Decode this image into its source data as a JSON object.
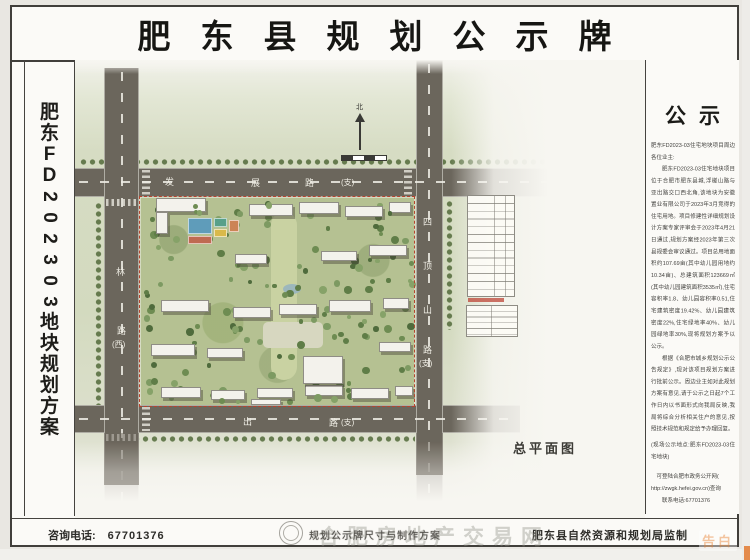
{
  "title": "肥东县规划公示牌",
  "left_panel": {
    "chars": [
      "肥",
      "东",
      "F",
      "D",
      "2",
      "0",
      "2",
      "3",
      "0",
      "3",
      "地",
      "块",
      "规",
      "划",
      "方",
      "案"
    ]
  },
  "map": {
    "caption": "总平面图",
    "north_label": "北",
    "road_top": [
      "发",
      "展",
      "路",
      "(支)"
    ],
    "road_left": [
      "林",
      "路",
      "(西)"
    ],
    "road_right": [
      "四",
      "顶",
      "山",
      "路",
      "(支)"
    ],
    "road_bottom": [
      "出",
      "路",
      "(支)"
    ]
  },
  "notice": {
    "heading": "公示",
    "salutation": "肥东FD2023-03住宅地块项目周边各位业主:",
    "paragraphs": [
      "肥东FD2023-03住宅地块项目位于合肥市肥东县城,浮槎山路与亚出路交口西北角,该地块为安徽置业有限公司于2023年3月竞得的住宅用地。项目修建性详细规划设计方案专家评审会于2023年4月21日通过,规划方案经2023年第三次县规委会审议通过。项目总用地面积约107.69亩(其中幼儿园用地约10.34亩)、总建筑面积123669㎡(其中幼儿园建筑面积3535㎡),住宅容积率1.8、幼儿园容积率0.51,住宅建筑密度19.42%、幼儿园建筑密度22%,住宅绿地率40%、幼儿园绿地率30%,现将规划方案予以公示。",
      "根据《合肥市城乡规划公示公告规定》,现对该项目规划方案进行批前公示。周边业主如对此规划方案有意见,请于公示之日起7个工作日内以书面形式向我局反映,我局将综合分析相关住户的意见,按照技术规范和规定给予办理回复。"
    ],
    "site_note": "(现场公示地点:肥东FD2023-03住宅地块)",
    "query_line1": "可登陆合肥市政务公开网(",
    "query_line2": "http://zwgk.hefei.gov.cn)查询",
    "contact_line": "联系电话:67701376"
  },
  "footer": {
    "phone_label": "咨询电话:",
    "phone_number": "67701376",
    "center_note": "规划公示牌尺寸与制作方案",
    "producer": "肥东县自然资源和规划局监制"
  },
  "watermarks": {
    "center": "合肥房地产交易网",
    "corner": "告白"
  },
  "colors": {
    "road": "#6b665c",
    "parcel_green": "#b5c192",
    "boundary_red": "#b6432e",
    "court_blue": "#5f9cba",
    "accent_red": "#c4574a"
  }
}
